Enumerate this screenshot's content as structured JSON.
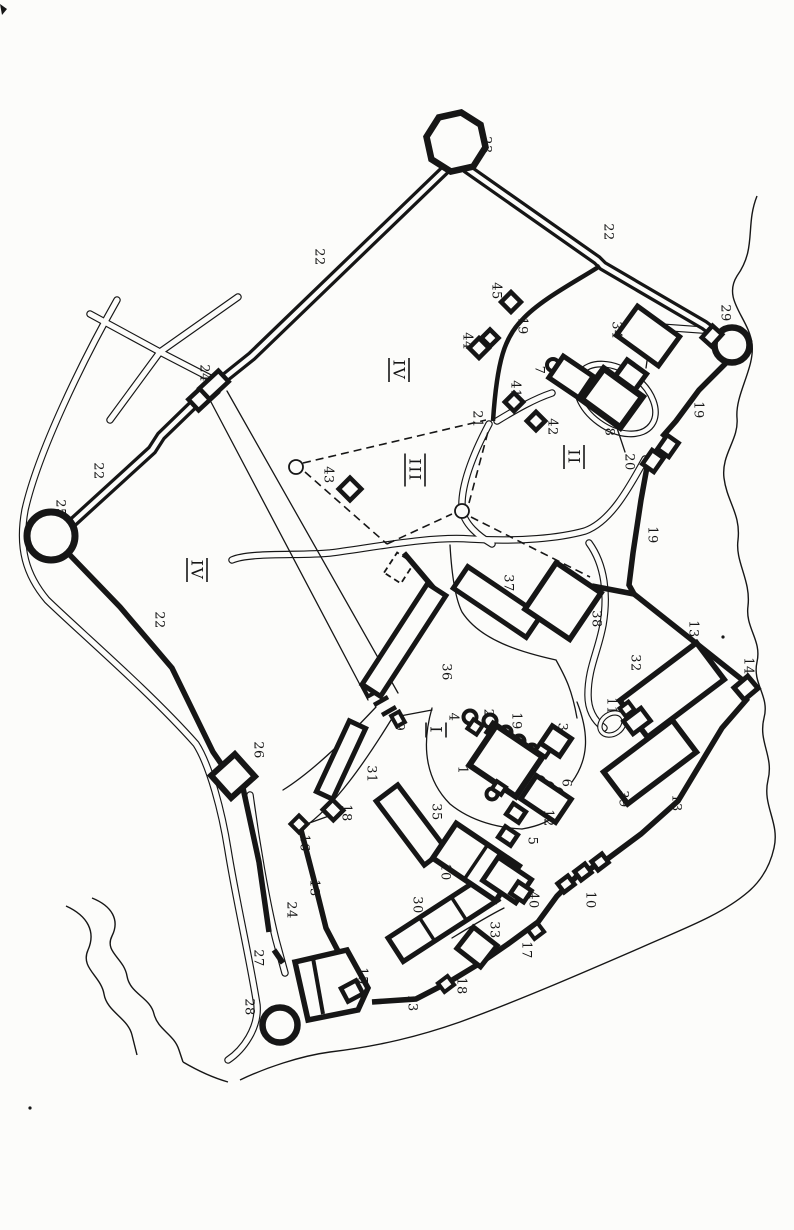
{
  "plan": {
    "ink_color": "#161616",
    "paper_color": "#fcfcfa",
    "figure_labels": [
      {
        "t": "1",
        "x": 463,
        "y": 770
      },
      {
        "t": "2",
        "x": 489,
        "y": 713
      },
      {
        "t": "3",
        "x": 563,
        "y": 727
      },
      {
        "t": "4",
        "x": 454,
        "y": 717
      },
      {
        "t": "5",
        "x": 533,
        "y": 841
      },
      {
        "t": "6",
        "x": 567,
        "y": 783
      },
      {
        "t": "7",
        "x": 540,
        "y": 370
      },
      {
        "t": "8",
        "x": 610,
        "y": 432
      },
      {
        "t": "9",
        "x": 400,
        "y": 727
      },
      {
        "t": "10",
        "x": 446,
        "y": 872
      },
      {
        "t": "10",
        "x": 591,
        "y": 900
      },
      {
        "t": "11",
        "x": 612,
        "y": 706
      },
      {
        "t": "12",
        "x": 549,
        "y": 818
      },
      {
        "t": "13",
        "x": 694,
        "y": 629
      },
      {
        "t": "13",
        "x": 677,
        "y": 803
      },
      {
        "t": "13",
        "x": 315,
        "y": 888
      },
      {
        "t": "13",
        "x": 413,
        "y": 1003
      },
      {
        "t": "14",
        "x": 749,
        "y": 666
      },
      {
        "t": "15",
        "x": 363,
        "y": 976
      },
      {
        "t": "16",
        "x": 305,
        "y": 843
      },
      {
        "t": "17",
        "x": 527,
        "y": 950
      },
      {
        "t": "18",
        "x": 347,
        "y": 813
      },
      {
        "t": "18",
        "x": 462,
        "y": 986
      },
      {
        "t": "19",
        "x": 523,
        "y": 326
      },
      {
        "t": "19",
        "x": 699,
        "y": 410
      },
      {
        "t": "19",
        "x": 653,
        "y": 535
      },
      {
        "t": "19",
        "x": 517,
        "y": 721
      },
      {
        "t": "20",
        "x": 630,
        "y": 462
      },
      {
        "t": "21",
        "x": 478,
        "y": 419
      },
      {
        "t": "22",
        "x": 320,
        "y": 257
      },
      {
        "t": "22",
        "x": 609,
        "y": 232
      },
      {
        "t": "22",
        "x": 99,
        "y": 471
      },
      {
        "t": "22",
        "x": 160,
        "y": 620
      },
      {
        "t": "23",
        "x": 487,
        "y": 145
      },
      {
        "t": "24",
        "x": 205,
        "y": 373
      },
      {
        "t": "24",
        "x": 292,
        "y": 910
      },
      {
        "t": "25",
        "x": 61,
        "y": 508
      },
      {
        "t": "26",
        "x": 259,
        "y": 750
      },
      {
        "t": "27",
        "x": 259,
        "y": 958
      },
      {
        "t": "28",
        "x": 250,
        "y": 1007
      },
      {
        "t": "29",
        "x": 726,
        "y": 313
      },
      {
        "t": "30",
        "x": 418,
        "y": 905
      },
      {
        "t": "31",
        "x": 372,
        "y": 774
      },
      {
        "t": "32",
        "x": 636,
        "y": 663
      },
      {
        "t": "33",
        "x": 495,
        "y": 930
      },
      {
        "t": "34",
        "x": 617,
        "y": 330
      },
      {
        "t": "35",
        "x": 437,
        "y": 812
      },
      {
        "t": "36",
        "x": 447,
        "y": 672
      },
      {
        "t": "37",
        "x": 509,
        "y": 583
      },
      {
        "t": "38",
        "x": 597,
        "y": 619
      },
      {
        "t": "39",
        "x": 624,
        "y": 799
      },
      {
        "t": "40",
        "x": 534,
        "y": 900
      },
      {
        "t": "41",
        "x": 516,
        "y": 389
      },
      {
        "t": "42",
        "x": 553,
        "y": 427
      },
      {
        "t": "43",
        "x": 329,
        "y": 475
      },
      {
        "t": "44",
        "x": 468,
        "y": 341
      },
      {
        "t": "45",
        "x": 497,
        "y": 291
      }
    ],
    "section_labels": [
      {
        "t": "I",
        "x": 436,
        "y": 730
      },
      {
        "t": "II",
        "x": 574,
        "y": 457
      },
      {
        "t": "III",
        "x": 415,
        "y": 470
      },
      {
        "t": "IV",
        "x": 197,
        "y": 570
      },
      {
        "t": "IV",
        "x": 399,
        "y": 370
      }
    ]
  }
}
